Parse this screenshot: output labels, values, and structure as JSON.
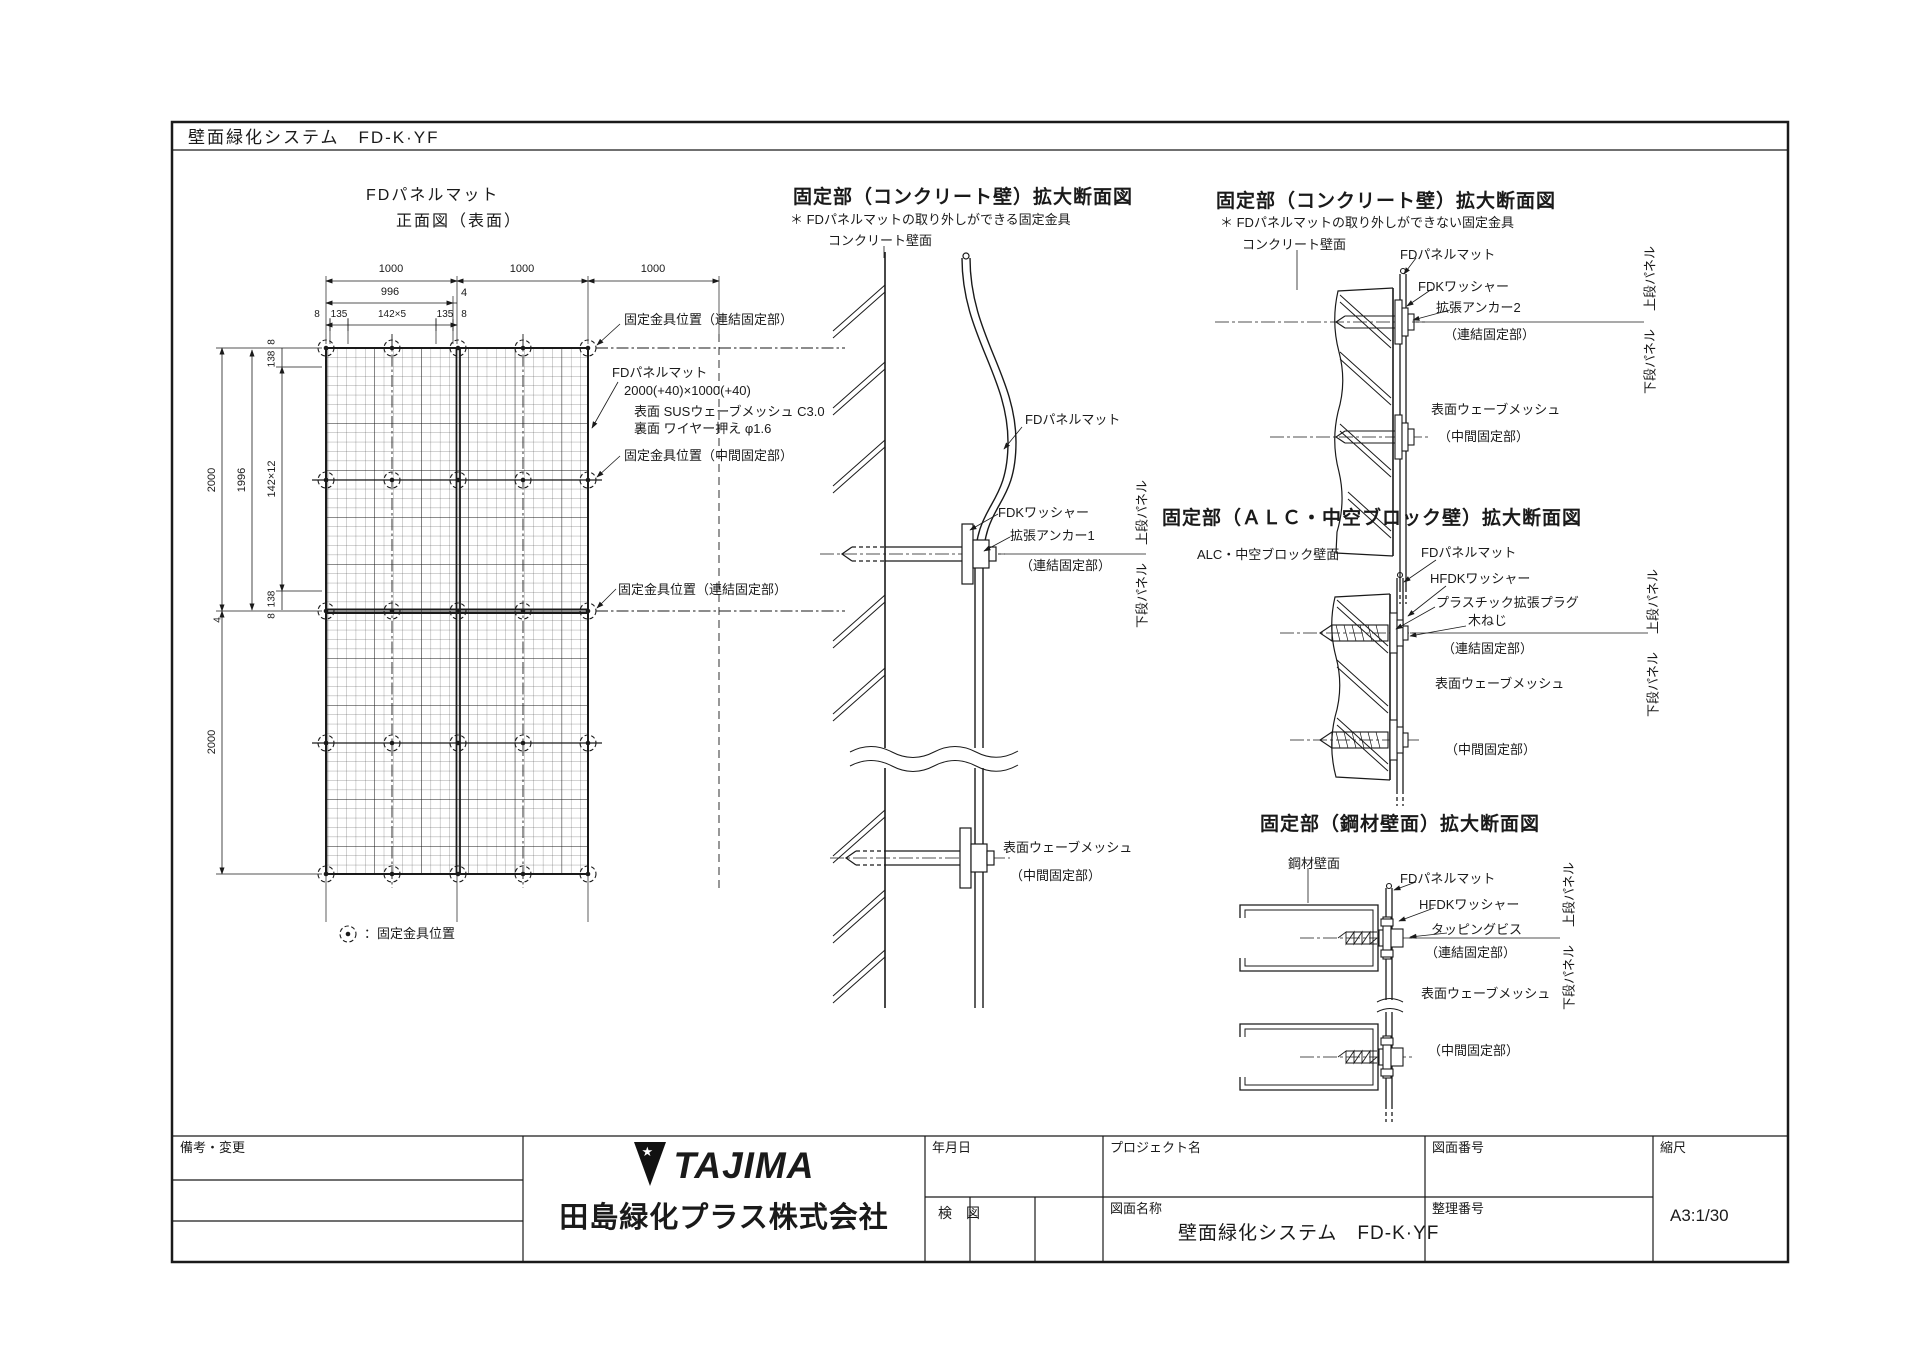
{
  "colors": {
    "ink": "#1a1a1a",
    "paper": "#ffffff"
  },
  "header": {
    "title": "壁面緑化システム　FD-K·YF"
  },
  "front_view": {
    "title1": "FDパネルマット",
    "title2": "正面図（表面）",
    "dims": {
      "t1000a": "1000",
      "t1000b": "1000",
      "t1000c": "1000",
      "t996": "996",
      "t4": "4",
      "r3_8a": "8",
      "r3_135a": "135",
      "r3_142": "142×5",
      "r3_135b": "135",
      "r3_8b": "8",
      "l2000a": "2000",
      "l1996": "1996",
      "l142": "142×12",
      "l8a": "8",
      "l138a": "138",
      "l138b": "138",
      "l8b": "8",
      "l4": "4",
      "l2000b": "2000"
    },
    "labels": {
      "fix_top": "固定金具位置（連結固定部）",
      "mat": "FDパネルマット",
      "mat_size": "2000(+40)×1000(+40)",
      "surf": "表面 SUSウェーブメッシュ C3.0",
      "back": "裏面 ワイヤー押え φ1.6",
      "fix_mid": "固定金具位置（中間固定部）",
      "fix_joint": "固定金具位置（連結固定部）",
      "legend": "：固定金具位置"
    }
  },
  "sec_concrete_removable": {
    "title": "固定部（コンクリート壁）拡大断面図",
    "note": "＊ FDパネルマットの取り外しができる固定金具",
    "wall": "コンクリート壁面",
    "mat": "FDパネルマット",
    "washer": "FDKワッシャー",
    "anchor": "拡張アンカー1",
    "joint": "（連結固定部）",
    "mesh": "表面ウェーブメッシュ",
    "mid": "（中間固定部）",
    "panel_lower": "下段パネル",
    "panel_upper": "上段パネル"
  },
  "sec_concrete_fixed": {
    "title": "固定部（コンクリート壁）拡大断面図",
    "note": "＊ FDパネルマットの取り外しができない固定金具",
    "wall": "コンクリート壁面",
    "mat": "FDパネルマット",
    "washer": "FDKワッシャー",
    "anchor": "拡張アンカー2",
    "joint": "（連結固定部）",
    "mesh": "表面ウェーブメッシュ",
    "mid": "（中間固定部）",
    "panel_lower": "下段パネル",
    "panel_upper": "上段パネル"
  },
  "sec_alc": {
    "title": "固定部（ＡＬＣ・中空ブロック壁）拡大断面図",
    "wall": "ALC・中空ブロック壁面",
    "mat": "FDパネルマット",
    "washer": "HFDKワッシャー",
    "plug": "プラスチック拡張プラグ",
    "screw": "木ねじ",
    "joint": "（連結固定部）",
    "mesh": "表面ウェーブメッシュ",
    "mid": "（中間固定部）",
    "panel_lower": "下段パネル",
    "panel_upper": "上段パネル"
  },
  "sec_steel": {
    "title": "固定部（鋼材壁面）拡大断面図",
    "wall": "鋼材壁面",
    "mat": "FDパネルマット",
    "washer": "HFDKワッシャー",
    "screw": "タッピングビス",
    "joint": "（連結固定部）",
    "mesh": "表面ウェーブメッシュ",
    "mid": "（中間固定部）",
    "panel_lower": "下段パネル",
    "panel_upper": "上段パネル"
  },
  "title_block": {
    "remarks": "備考・変更",
    "date": "年月日",
    "check": "検　図",
    "project": "プロジェクト名",
    "drawing_no": "図面番号",
    "scale": "縮尺",
    "drawing_name": "図面名称",
    "drawing_name_value": "壁面緑化システム　FD-K·YF",
    "ref_no": "整理番号",
    "scale_value": "A3:1/30",
    "logo_text": "TAJIMA",
    "logo_star": "★",
    "company": "田島緑化プラス株式会社"
  }
}
